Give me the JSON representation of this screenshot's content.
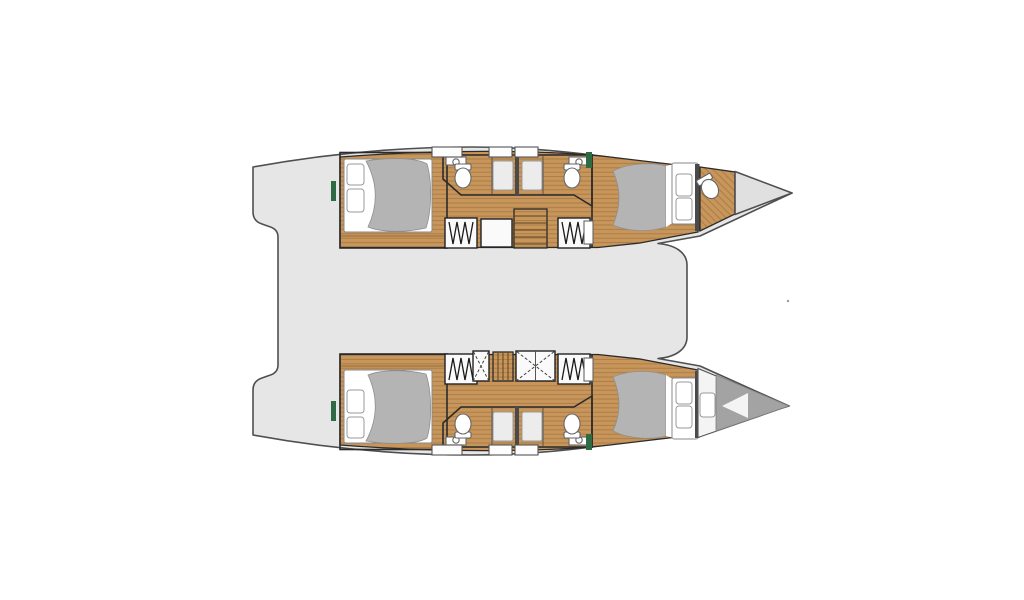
{
  "meta": {
    "title": "Catamaran lower-deck floor plan",
    "type": "floor-plan",
    "view": "top-down"
  },
  "canvas": {
    "width": 1024,
    "height": 600
  },
  "colors": {
    "background": "#ffffff",
    "deck": "#e6e6e6",
    "hull_outline": "#4f4f4f",
    "wall": "#2b2b2b",
    "wood": "#c8955a",
    "wood_line": "#8a6536",
    "duvet_gray": "#b4b4b4",
    "bow_bed_gray": "#a3a3a3",
    "mattress_white": "#ffffff",
    "bathroom_floor": "#f4f4f4",
    "hatch_box": "#f0f0f0",
    "forepeak": "#e0e0e0",
    "green_trim": "#2e6b45"
  },
  "vessel": {
    "type": "catamaran",
    "bow_direction": "right",
    "hulls": [
      {
        "id": "port",
        "position": "top",
        "rooms": [
          "aft double cabin",
          "bathroom with toilet and shower",
          "bathroom with toilet and shower",
          "forward double cabin",
          "bow head with toilet",
          "forepeak locker"
        ]
      },
      {
        "id": "starboard",
        "position": "bottom",
        "rooms": [
          "aft double cabin",
          "bathroom with toilet and shower",
          "bathroom with toilet and shower",
          "forward double cabin",
          "bow berth",
          "forepeak"
        ]
      }
    ],
    "fixtures": {
      "double_beds": 4,
      "bow_berths": 1,
      "toilets": 5,
      "shower_stalls": 4,
      "companionway_stairs": 4,
      "deck_hatches": 6,
      "skylight_hatches": 2
    }
  }
}
